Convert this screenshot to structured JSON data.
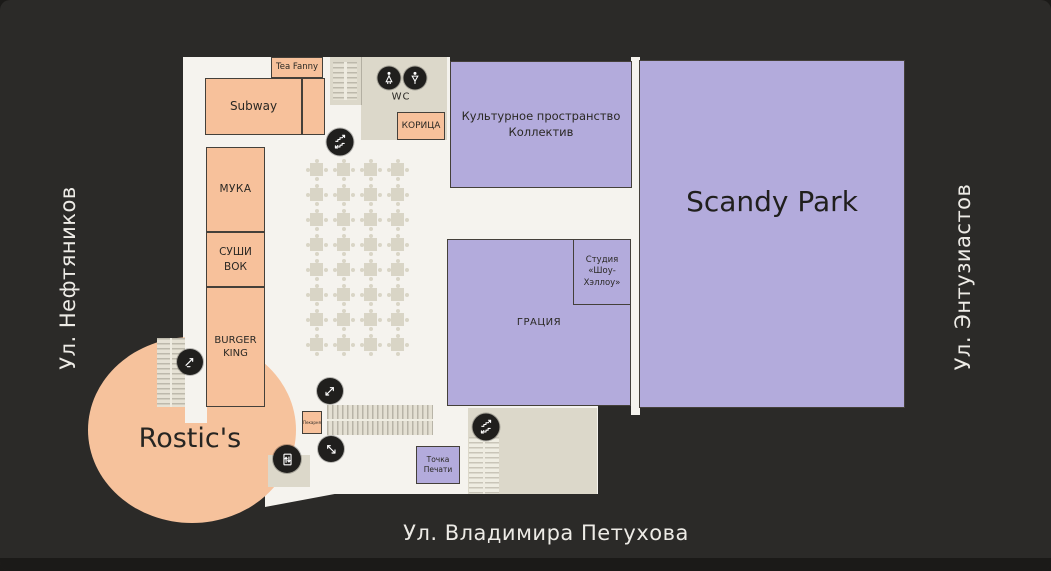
{
  "map_title": "Mall floor plan",
  "streets": {
    "left": "Ул. Нефтяников",
    "right": "Ул. Энтузиастов",
    "bottom": "Ул. Владимира Петухова"
  },
  "stores": {
    "tea_fanny": "Tea Fanny",
    "subway": "Subway",
    "muka": "МУКА",
    "sushi_wok": "СУШИ ВОК",
    "burger_king": "BURGER KING",
    "koritsa": "КОРИЦА",
    "rostics": "Rostic's",
    "bakery_kiosk": "Пекарня",
    "kollektiv": [
      "Культурное пространство",
      "Коллектив"
    ],
    "scandy_park": "Scandy Park",
    "graciya": "ГРАЦИЯ",
    "studio": [
      "Студия",
      "«Шоу-Хэллоу»"
    ],
    "tochka_pechati": "Точка Печати",
    "wc": "WC"
  },
  "icons": {
    "wc_female": "woman-icon",
    "wc_male": "man-icon",
    "stairs_top": "stairs-icon",
    "stairs_bottom": "stairs-icon",
    "escalator_left": "escalator-icon",
    "escalator_up": "escalator-up-icon",
    "escalator_down": "escalator-down-icon",
    "elevator": "elevator-icon"
  },
  "food_court": {
    "rows": 8,
    "cols": 4,
    "step_x": 27,
    "step_y": 25
  },
  "colors": {
    "background": "#2b2a28",
    "floor": "#f5f3ee",
    "store_orange": "#f7c19b",
    "store_purple": "#b3abdc",
    "zone_beige": "#dcd8ca",
    "icon_circle": "#201f1d",
    "street_text": "#edebe6"
  }
}
